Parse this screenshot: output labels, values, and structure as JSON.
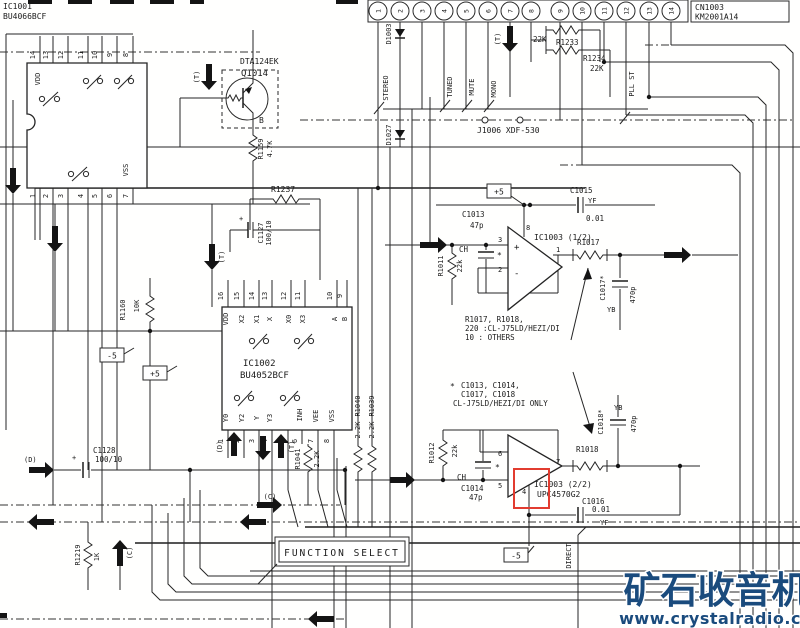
{
  "schematic": {
    "top_connector": {
      "ref": "CN1003",
      "part": "KM2001A14",
      "pins": [
        "1",
        "2",
        "3",
        "4",
        "5",
        "6",
        "7",
        "8",
        "9",
        "10",
        "11",
        "12",
        "13",
        "14"
      ]
    },
    "ic1001": {
      "ref": "IC1001",
      "part": "BU4066BCF",
      "vdd": "VDD",
      "vss": "VSS",
      "top_pins": [
        "14",
        "13",
        "12",
        "11",
        "10",
        "9",
        "8"
      ],
      "bottom_pins": [
        "1",
        "2",
        "3",
        "4",
        "5",
        "6",
        "7"
      ]
    },
    "q1014": {
      "part": "DTA124EK",
      "ref": "Q1014",
      "terminal_b": "B"
    },
    "ic1002": {
      "ref": "IC1002",
      "part": "BU4052BCF",
      "top_numbers": [
        "16",
        "15",
        "14",
        "13",
        "12",
        "11",
        "10",
        "9"
      ],
      "top_labels": [
        "VDD",
        "X2",
        "X1",
        "X",
        "X0",
        "X3",
        "A",
        "B"
      ],
      "bottom_labels": [
        "Y0",
        "Y2",
        "Y",
        "Y3",
        "Y1",
        "INH",
        "VEE",
        "VSS"
      ],
      "bottom_numbers": [
        "1",
        "2",
        "3",
        "4",
        "5",
        "6",
        "7",
        "8"
      ]
    },
    "opamp1": {
      "ref": "IC1003 (1/2)",
      "pin_plus": "3",
      "pin_minus": "2",
      "pin_out": "1",
      "pin_vcc": "8",
      "plus": "+",
      "minus": "-"
    },
    "opamp2": {
      "ref": "IC1003 (2/2)",
      "part": "UPC4570G2",
      "pin_minus": "6",
      "pin_plus": "5",
      "pin_out": "7",
      "pin_vee": "4"
    },
    "resistors": {
      "r1159": {
        "ref": "R1159",
        "value": "4.7K"
      },
      "r1237": {
        "ref": "R1237"
      },
      "r1160": {
        "ref": "R1160",
        "value": "10K"
      },
      "r1233": {
        "ref": "R1233",
        "value": "22K"
      },
      "r1234": {
        "ref": "R1234",
        "value": "22K"
      },
      "r1041": {
        "ref": "R1041",
        "value": "2.2K"
      },
      "r1040": {
        "ref": "R1040",
        "value": "2.2K"
      },
      "r1039": {
        "ref": "R1039",
        "value": "2.2K"
      },
      "r1011": {
        "ref": "R1011",
        "value": "22k"
      },
      "r1012": {
        "ref": "R1012",
        "value": "22k"
      },
      "r1017": {
        "ref": "R1017"
      },
      "r1018": {
        "ref": "R1018"
      },
      "r1219": {
        "ref": "R1219",
        "value": "1K"
      }
    },
    "capacitors": {
      "c1127": {
        "ref": "C1127",
        "value": "100/10"
      },
      "c1128": {
        "ref": "C1128",
        "value": "100/10"
      },
      "c1013": {
        "ref": "C1013",
        "value": "47p"
      },
      "c1014": {
        "ref": "C1014",
        "value": "47p"
      },
      "c1015": {
        "ref": "C1015",
        "value": "0.01",
        "marking": "YF"
      },
      "c1016": {
        "ref": "C1016",
        "value": "0.01",
        "marking": "YF"
      },
      "c1017": {
        "ref": "C1017*",
        "value": "470p",
        "marking": "YB"
      },
      "c1018": {
        "ref": "C1018*",
        "value": "470p",
        "marking": "YB"
      }
    },
    "diodes": {
      "d1003": "D1003",
      "d1027": "D1027"
    },
    "signals": {
      "stereo": "STEREO",
      "tuned": "TUNED",
      "mute": "MUTE",
      "mono": "MONO",
      "pll_st": "PLL ST",
      "direct": "DIRECT"
    },
    "jack": {
      "label": "J1006  XDF-530"
    },
    "power": {
      "plus5": "+5",
      "minus5": "-5"
    },
    "flags": {
      "t": "(T)",
      "d": "(D)",
      "c": "(C)",
      "ch": "CH",
      "star": "*",
      "plus": "+"
    },
    "notes": {
      "n1_l1": "R1017, R1018,",
      "n1_l2": "220 :CL-J75LD/HEZI/DI",
      "n1_l3": "10 : OTHERS",
      "n2_l1": "C1013, C1014,",
      "n2_l2": "C1017, C1018",
      "n2_l3": "CL-J75LD/HEZI/DI ONLY"
    },
    "function_select": "FUNCTION SELECT"
  },
  "watermark": {
    "title": "矿石收音机",
    "url": "www.crystalradio.cn"
  }
}
